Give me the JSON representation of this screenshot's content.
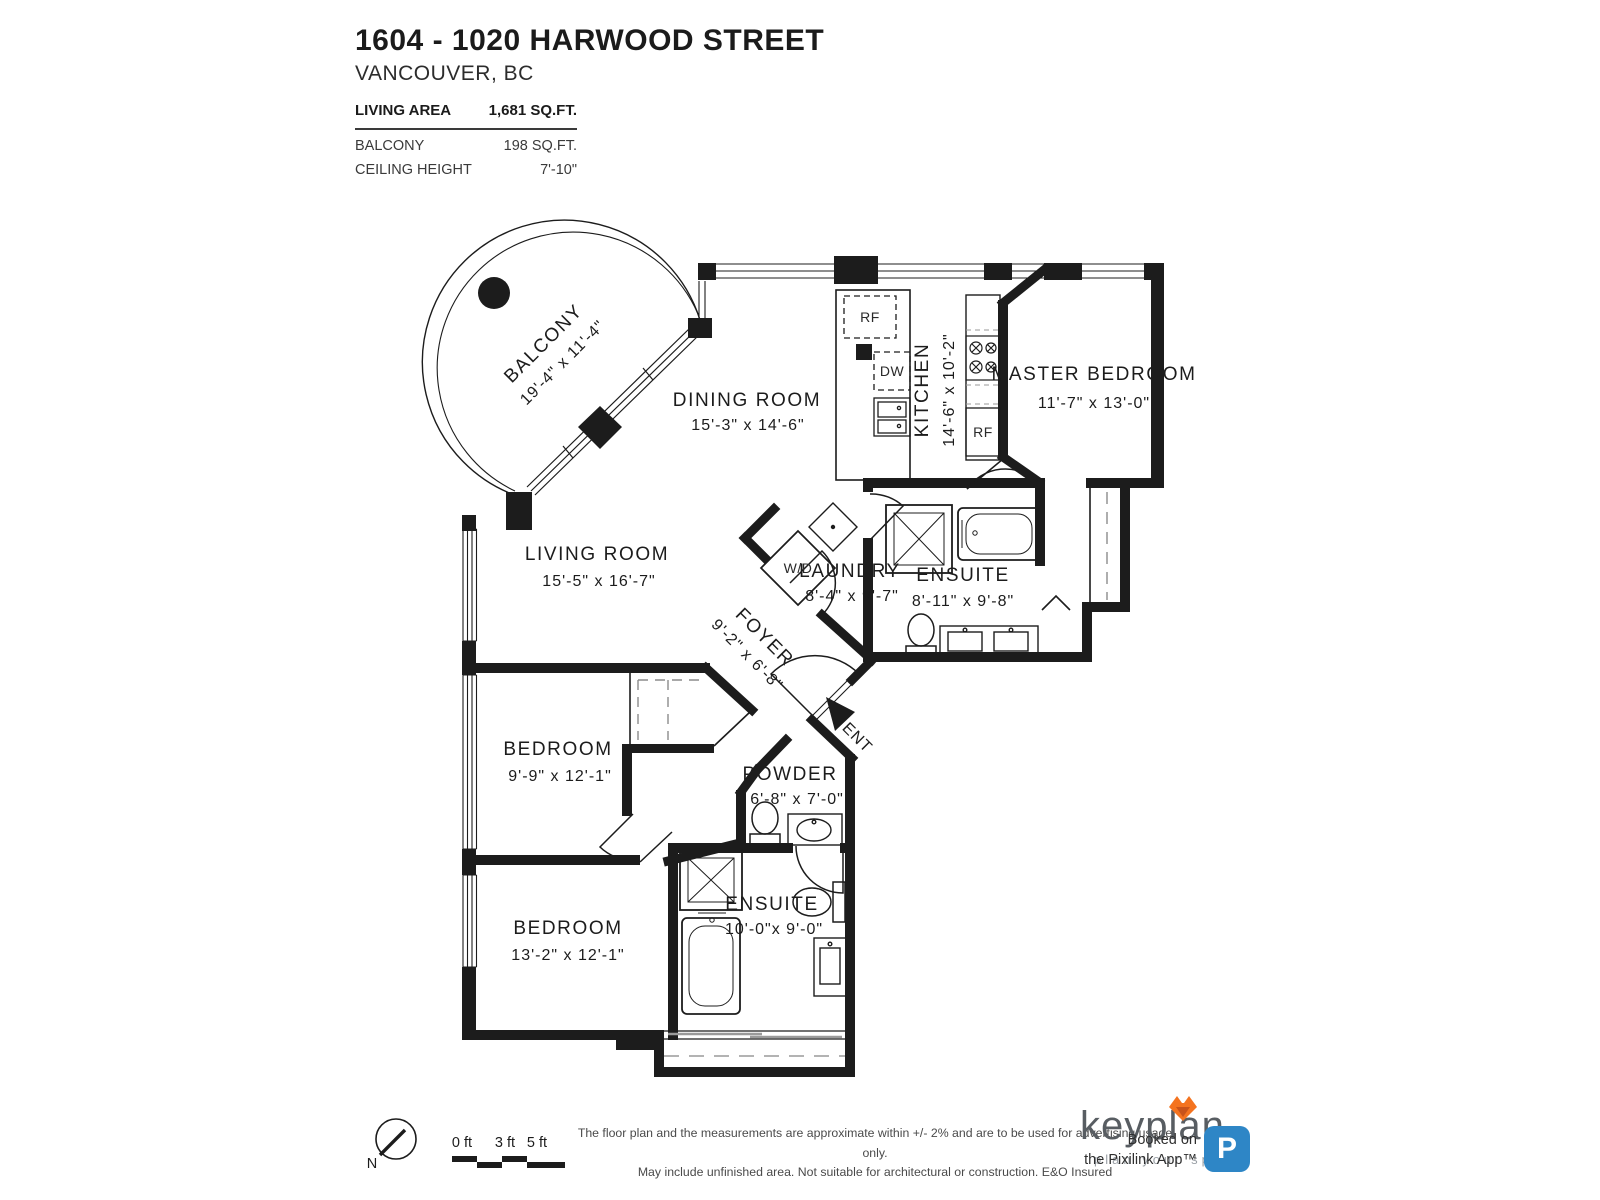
{
  "header": {
    "title": "1604 - 1020 HARWOOD STREET",
    "subtitle": "VANCOUVER, BC",
    "stats": [
      {
        "label": "LIVING AREA",
        "value": "1,681 SQ.FT."
      },
      {
        "label": "BALCONY",
        "value": "198 SQ.FT."
      },
      {
        "label": "CEILING HEIGHT",
        "value": "7'-10\""
      }
    ]
  },
  "rooms": {
    "balcony": {
      "name": "BALCONY",
      "dims": "19'-4\" x 11'-4\""
    },
    "dining": {
      "name": "DINING ROOM",
      "dims": "15'-3\" x 14'-6\""
    },
    "kitchen": {
      "name": "KITCHEN",
      "dims": "14'-6\" x 10'-2\""
    },
    "master": {
      "name": "MASTER BEDROOM",
      "dims": "11'-7\" x 13'-0\""
    },
    "living": {
      "name": "LIVING ROOM",
      "dims": "15'-5\" x 16'-7\""
    },
    "laundry": {
      "name": "LAUNDRY",
      "dims": "8'-4\" x 9'-7\""
    },
    "ensuite1": {
      "name": "ENSUITE",
      "dims": "8'-11\" x 9'-8\""
    },
    "foyer": {
      "name": "FOYER",
      "dims": "9'-2\" x 6'-8\""
    },
    "bedroom1": {
      "name": "BEDROOM",
      "dims": "9'-9\" x 12'-1\""
    },
    "powder": {
      "name": "POWDER",
      "dims": "6'-8\" x 7'-0\""
    },
    "ensuite2": {
      "name": "ENSUITE",
      "dims": "10'-0\"x 9'-0\""
    },
    "bedroom2": {
      "name": "BEDROOM",
      "dims": "13'-2\" x 12'-1\""
    }
  },
  "fixtures": {
    "rf_top": "RF",
    "dw": "DW",
    "rf_side": "RF",
    "wd": "W/D"
  },
  "entry": {
    "label": "ENT"
  },
  "compass": {
    "label": "N"
  },
  "scale": {
    "ticks": [
      "0 ft",
      "3 ft",
      "5 ft"
    ]
  },
  "footer": {
    "disclaimer1": "The floor plan and the measurements are approximate within +/- 2% and are to be used for advertising usage only.",
    "disclaimer2": "May include unfinished area. Not suitable for architectural or construction. E&O Insured",
    "keyplan_brand": "keyplan",
    "keyplan_tagline": "plan your space",
    "booked1": "Booked on",
    "booked2": "the Pixilink App™",
    "badge_letter": "P",
    "colors": {
      "badge": "#2E86C6",
      "fox_main": "#F4731F",
      "fox_dark": "#C9531A"
    }
  }
}
